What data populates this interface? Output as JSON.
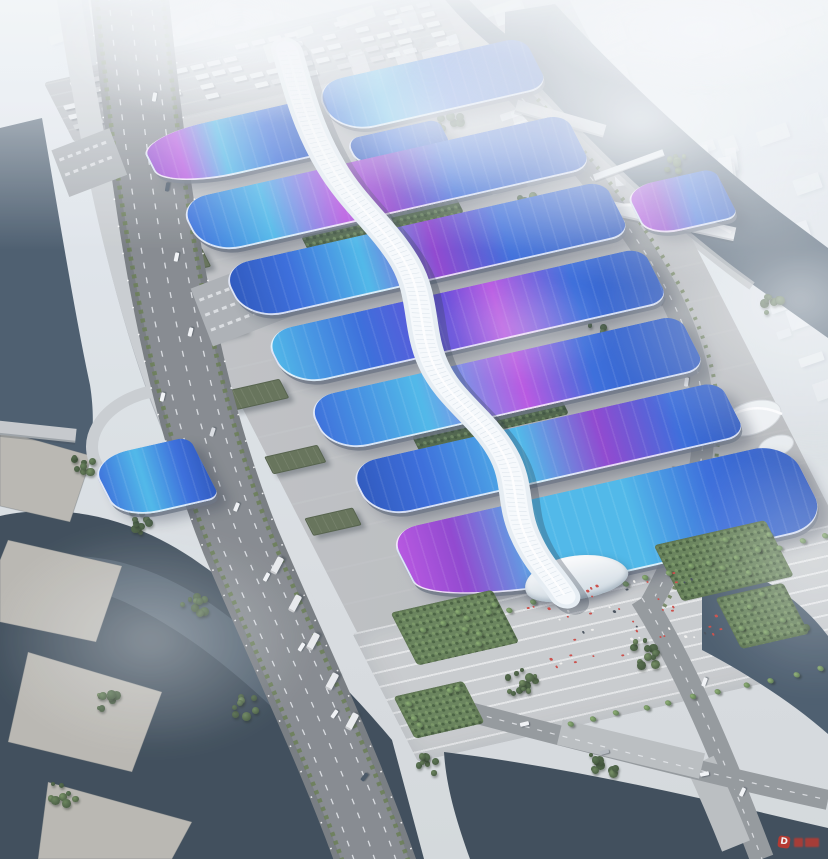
{
  "scene": {
    "description": "Bird's-eye architectural rendering of a vast exhibition and convention center: parallel rows of wave-form exhibition hall roofs in royal blue with cyan and magenta ribbon gradients, crossed by a white serpentine central concourse canopy that ends at a curved glass entrance hall beside a striped pedestrian plaza with palm trees and visitors; the site is bordered by a multi-lane boulevard and elevated viaduct over a dark river to the west, a truck marshalling yard to the north, and a hazy white city grid with canals, bridges and towers to the east.",
    "watermark": {
      "label": "D"
    }
  },
  "palette": {
    "sky": "#dfe7ee",
    "haze": "#f3f6f8",
    "roof_blue": "#2b62d9",
    "roof_deep_blue": "#1c4ab8",
    "roof_cyan": "#41b4e8",
    "roof_magenta": "#b44ae0",
    "roof_purple": "#8838cc",
    "roof_violet": "#5b3fd8",
    "spine_white": "#eef5f9",
    "apron_grey": "#b7babd",
    "plaza_grey": "#c6c9cb",
    "road_asphalt": "#6e7378",
    "road_concrete": "#8d9296",
    "viaduct_grey": "#c7cbce",
    "water_dark": "#3e5163",
    "water_deep": "#2f3f4d",
    "tree_green": "#566e49",
    "lawn_green": "#5d7a4e",
    "warehouse_green": "#5a684c",
    "city_white": "#eef1f3",
    "crowd_red": "#c8403a"
  }
}
